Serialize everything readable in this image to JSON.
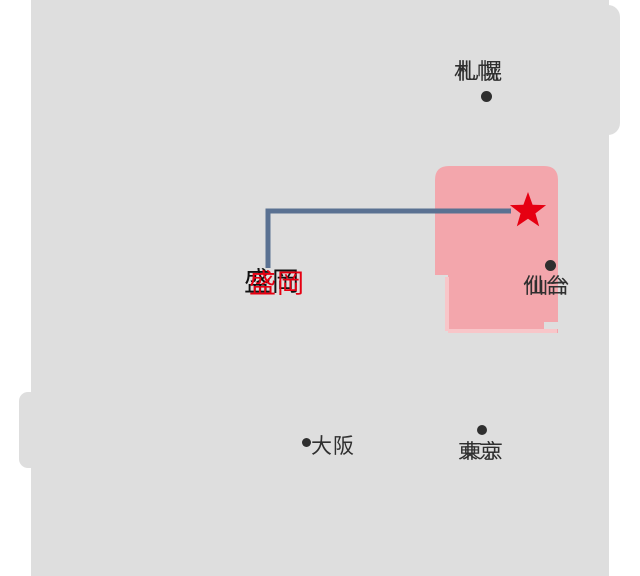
{
  "map": {
    "description_labels_only": "stylized Japan map",
    "sea_color": "#ffffff",
    "land_color": "#dedede",
    "highlight_region_color": "#f3a6ac",
    "leader_line_color": "#5a7192",
    "marker": {
      "shape": "star",
      "symbol": "★",
      "color": "#e60012"
    },
    "cities": [
      {
        "name": "sapporo",
        "label": "札幌",
        "dot_position": "below",
        "color": "#2f2f2f"
      },
      {
        "name": "morioka",
        "label": "盛岡",
        "highlighted": true,
        "color": "#e60012"
      },
      {
        "name": "sendai",
        "label": "仙台",
        "dot_position": "above",
        "color": "#2f2f2f"
      },
      {
        "name": "tokyo",
        "label": "東京",
        "dot_position": "above",
        "color": "#2f2f2f"
      },
      {
        "name": "osaka",
        "label": "大阪",
        "dot_position": "left",
        "color": "#2f2f2f"
      }
    ]
  }
}
